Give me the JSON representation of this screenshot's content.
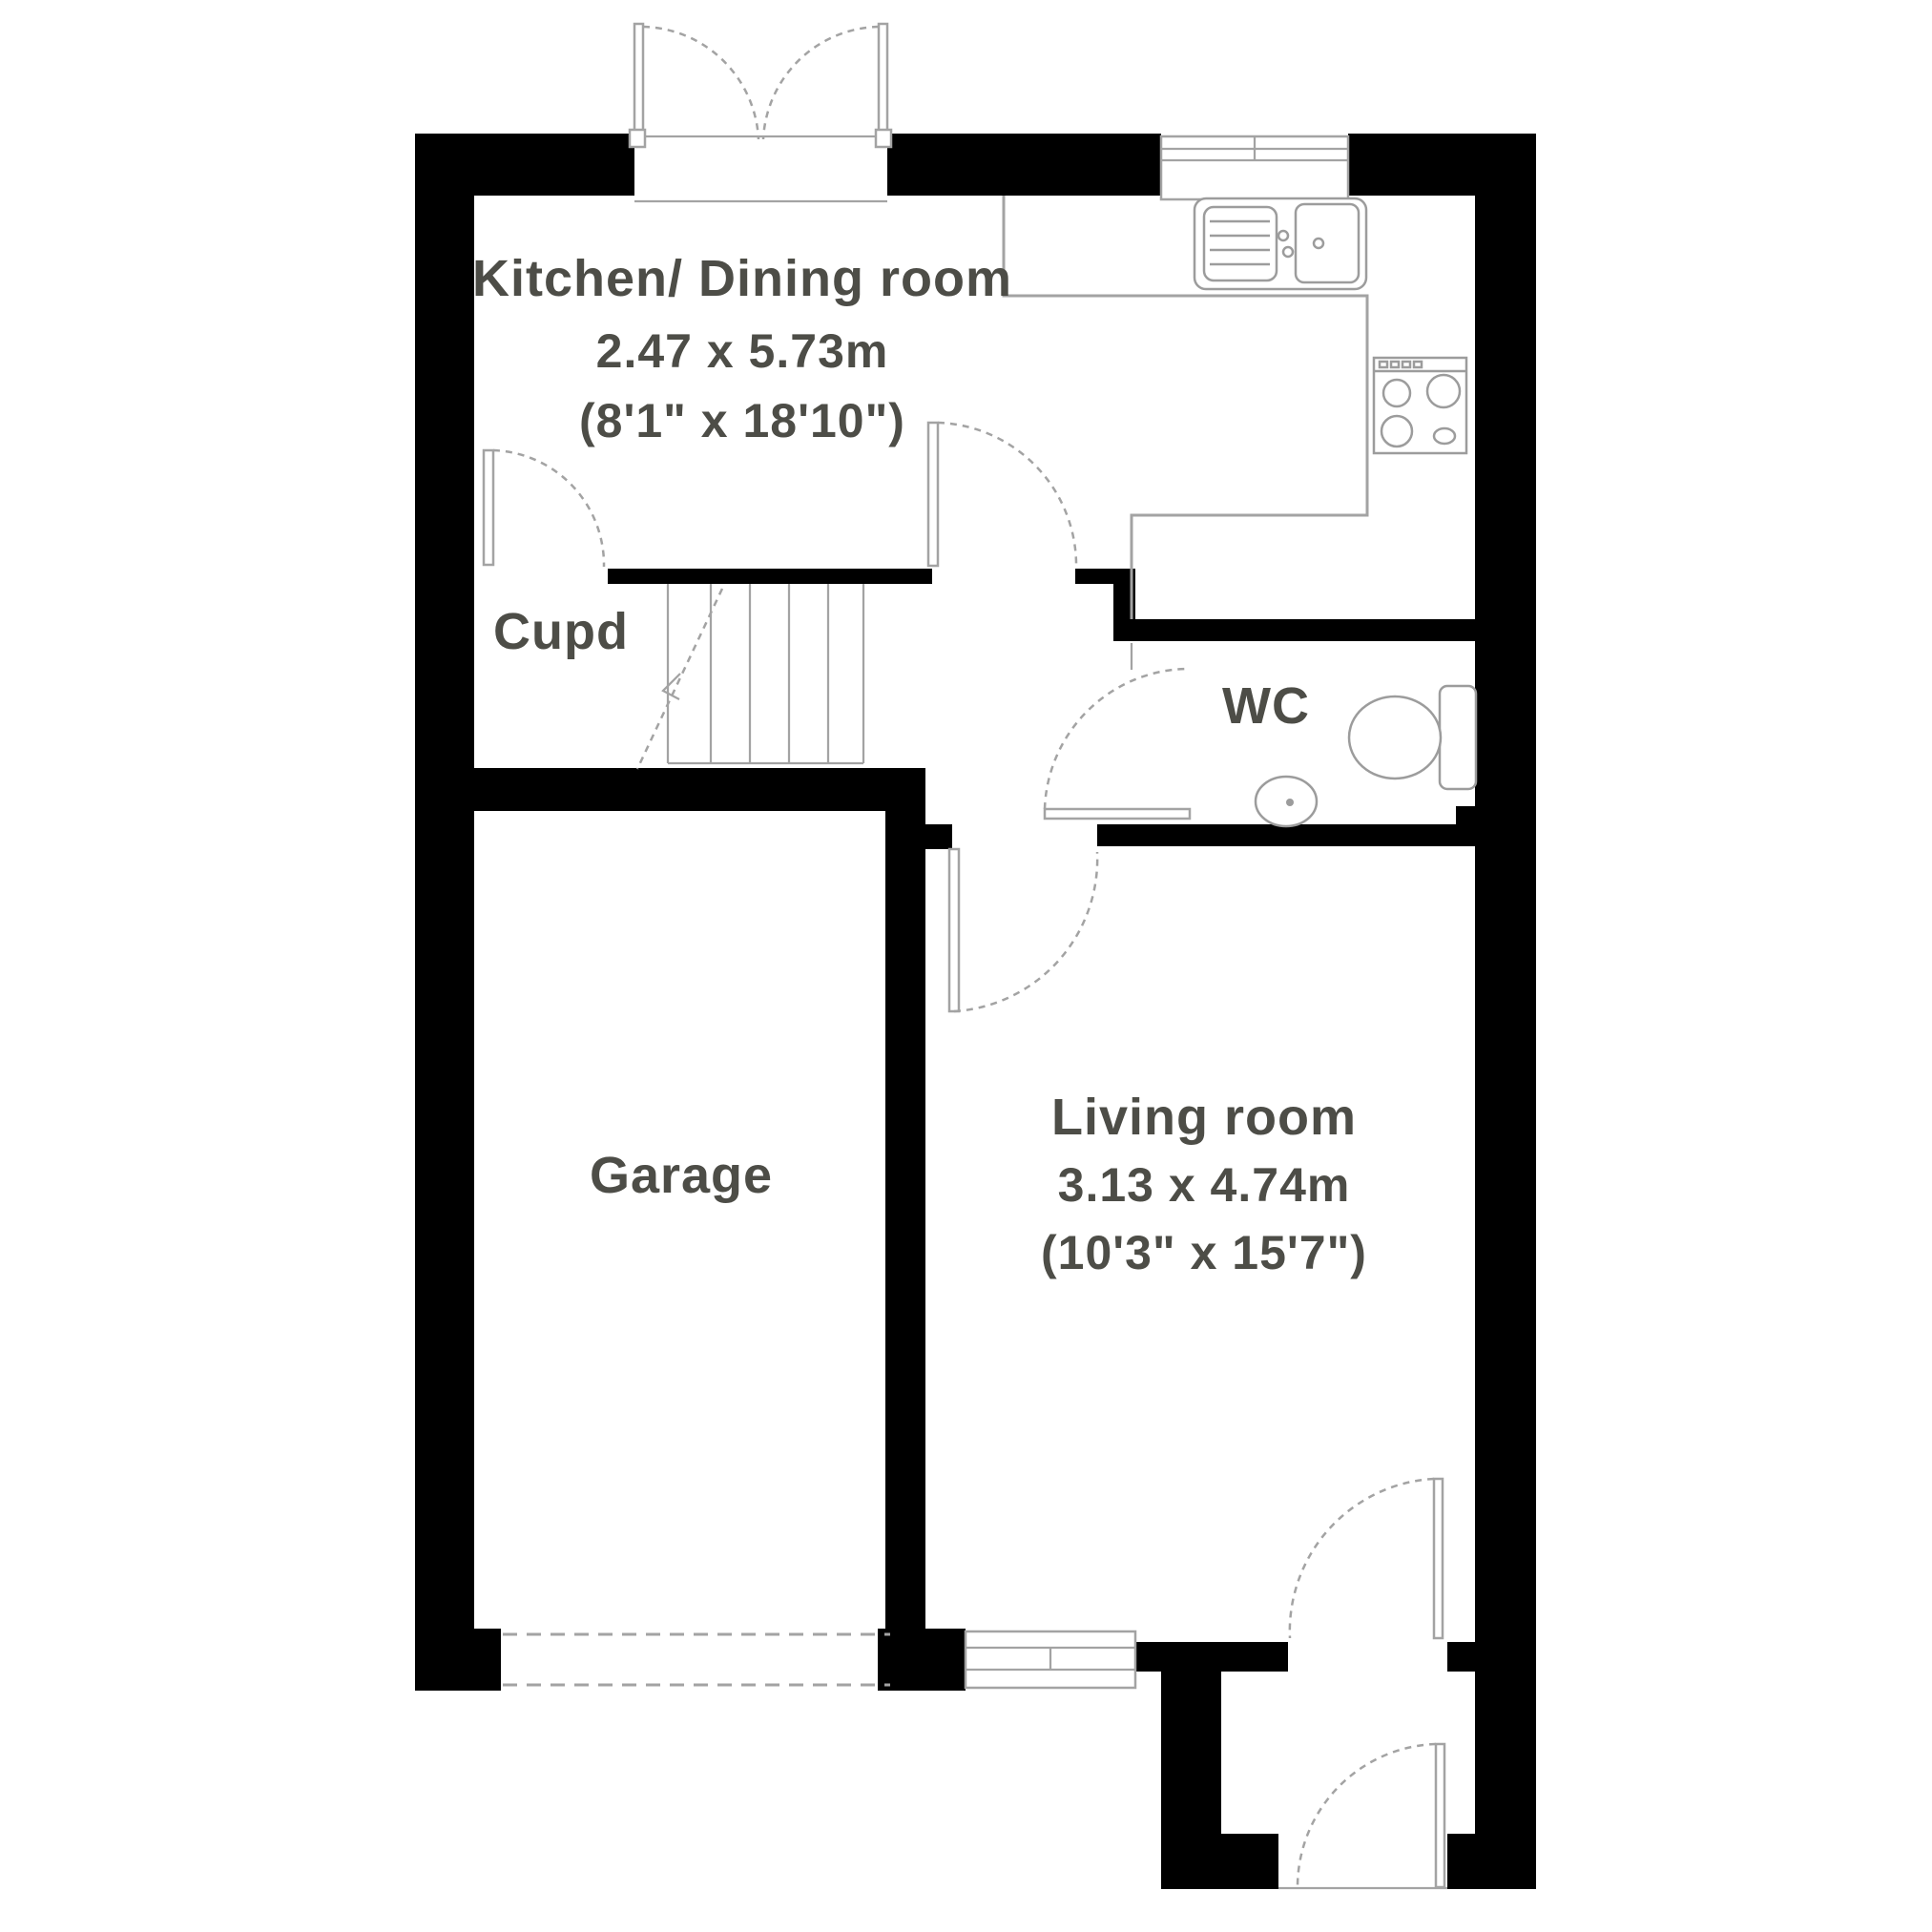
{
  "plan": {
    "type": "ground-floor-plan",
    "rooms": {
      "kitchen": {
        "name": "Kitchen/ Dining room",
        "size_metric": "2.47 x 5.73m",
        "size_imperial": "(8'1\" x 18'10\")"
      },
      "cupboard": {
        "name": "Cupd"
      },
      "wc": {
        "name": "WC"
      },
      "garage": {
        "name": "Garage"
      },
      "living": {
        "name": "Living room",
        "size_metric": "3.13 x 4.74m",
        "size_imperial": "(10'3\" x 15'7\")"
      }
    },
    "fixtures": [
      "sink-icon",
      "hob-icon",
      "toilet-icon",
      "basin-icon",
      "stairs-up"
    ],
    "colors": {
      "wall": "#000000",
      "line": "#a3a3a3",
      "fixture": "#9c9c9c",
      "text": "#4d4d47",
      "bg": "#ffffff"
    }
  }
}
